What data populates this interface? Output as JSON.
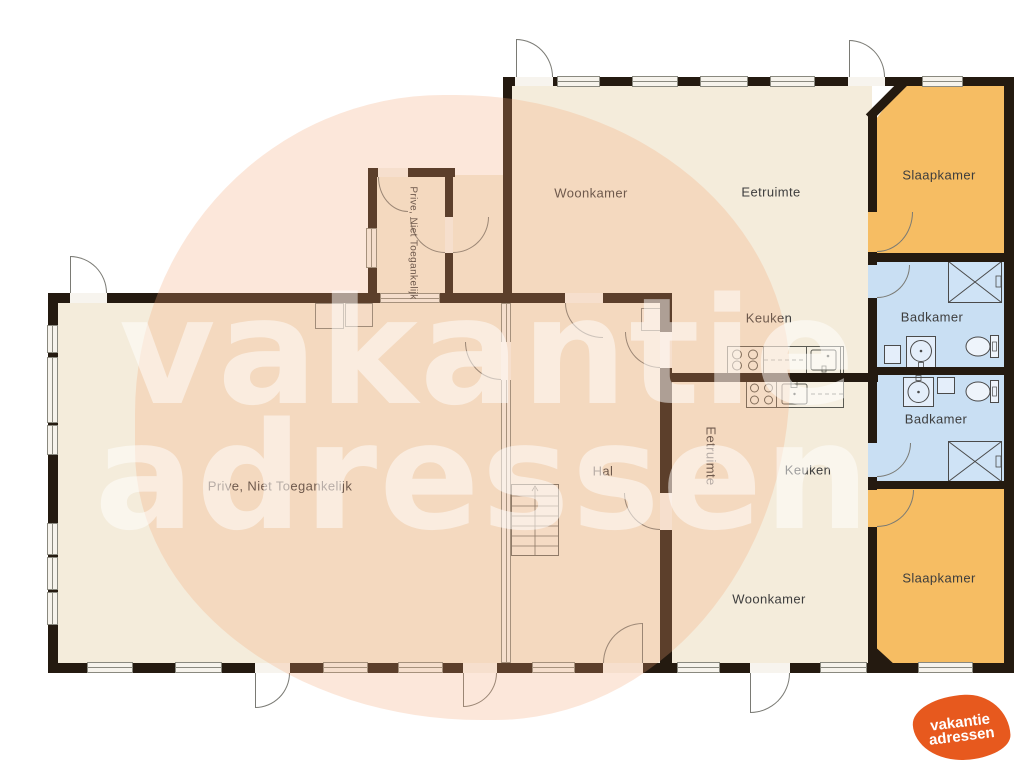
{
  "title": "Floor plan (plattegrond)",
  "watermark": {
    "line1": "vakantie",
    "line2": "adressen"
  },
  "logo": {
    "line1": "vakantie",
    "line2": "adressen"
  },
  "colors": {
    "wall": "#241a10",
    "room_cream": "#f4ecdb",
    "bedroom_orange": "#f6bd63",
    "bathroom_blue": "#c9dff3",
    "window": "#f6f3ec",
    "label_text": "#3d3d3d",
    "logo_orange": "#e7591e",
    "watermark_peach": "#f8c9a8"
  },
  "rooms": {
    "woonkamer_top": {
      "label": "Woonkamer"
    },
    "eetruimte_top": {
      "label": "Eetruimte"
    },
    "slaapkamer_top": {
      "label": "Slaapkamer"
    },
    "badkamer_top": {
      "label": "Badkamer"
    },
    "keuken_top": {
      "label": "Keuken"
    },
    "corridor": {
      "label": "Prive, Niet Toegankelijk"
    },
    "prive": {
      "label": "Prive, Niet Toegankelijk"
    },
    "hal": {
      "label": "Hal"
    },
    "eetruimte_bottom": {
      "label": "Eetruimte"
    },
    "keuken_bottom": {
      "label": "Keuken"
    },
    "woonkamer_bottom": {
      "label": "Woonkamer"
    },
    "badkamer_bottom": {
      "label": "Badkamer"
    },
    "slaapkamer_bottom": {
      "label": "Slaapkamer"
    }
  }
}
